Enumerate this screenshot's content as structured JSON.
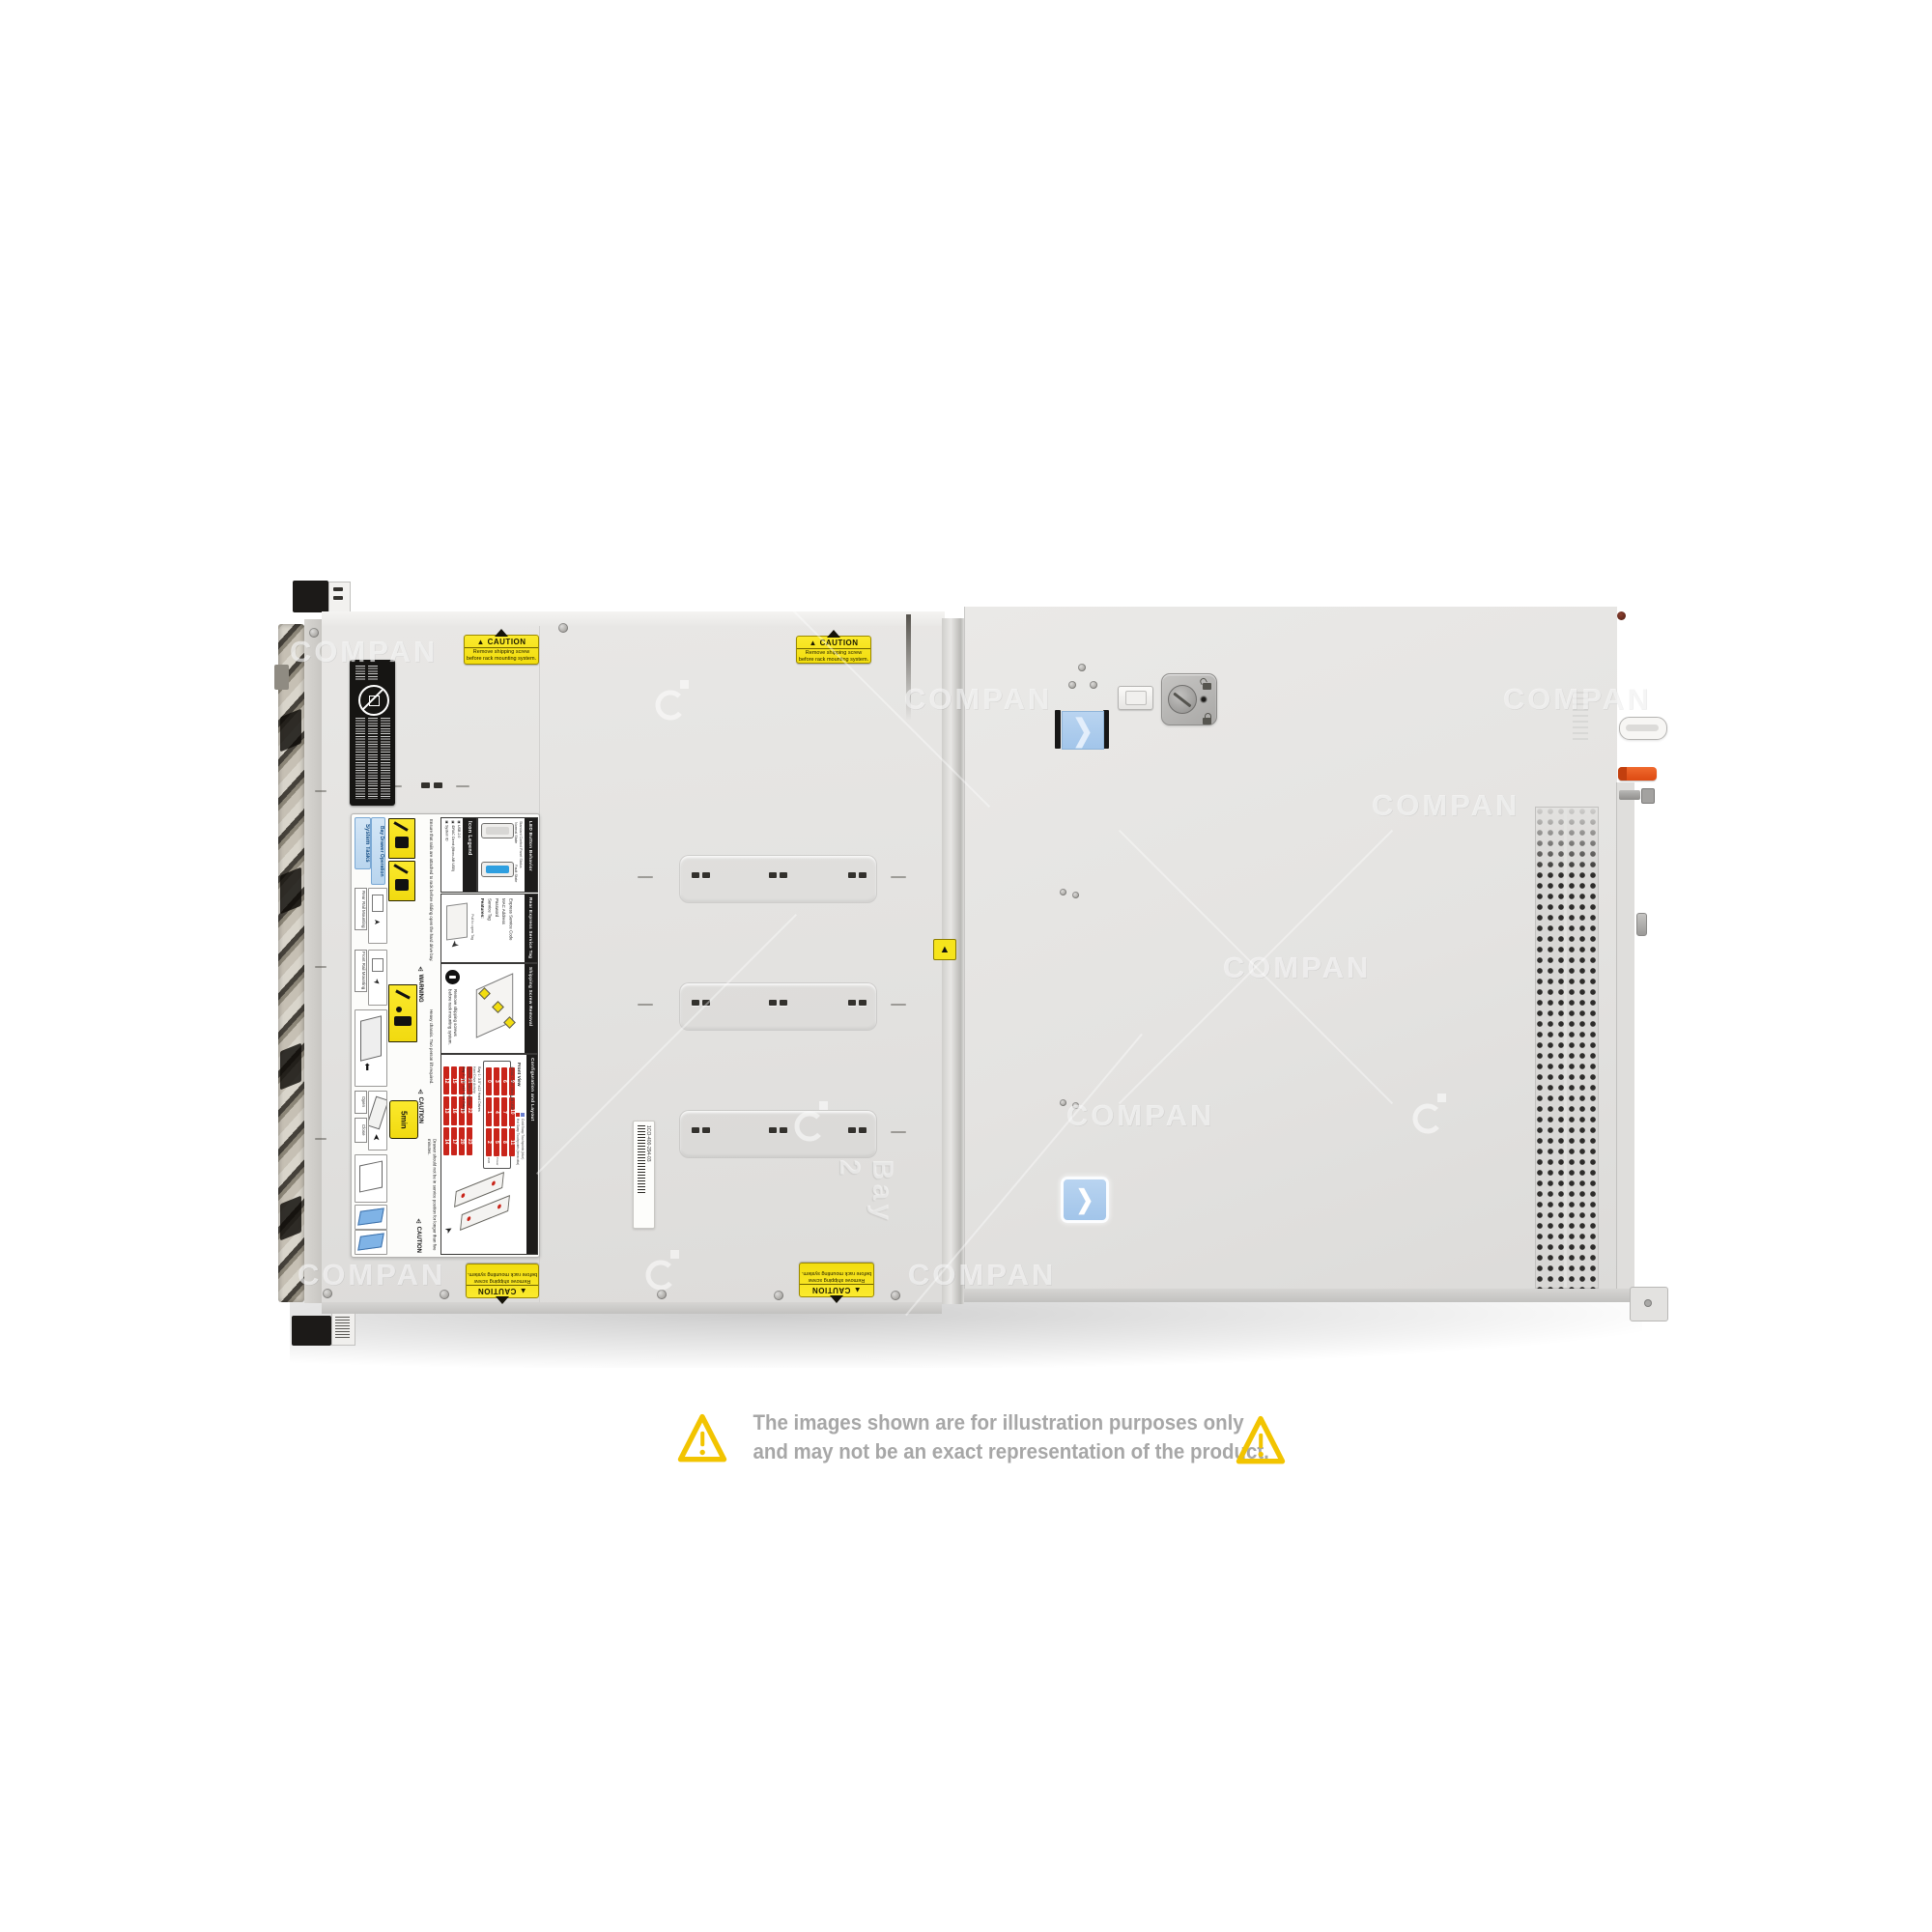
{
  "watermark": {
    "text": "COMPAN",
    "logo": "ci-logo"
  },
  "disclaimer": {
    "line1": "The images shown are for illustration purposes only",
    "line2": "and may not be an exact representation of the product.",
    "icon": "warning-triangle-icon",
    "text_color": "#a7a7a7",
    "triangle_color": "#f2c400"
  },
  "stickers": {
    "caution": {
      "title": "CAUTION",
      "icon": "warning-triangle-icon",
      "line1": "Remove shipping screw",
      "line2": "before rack mounting system.",
      "bg": "#f6e41c"
    }
  },
  "labels": {
    "regulatory": {
      "symbol": "prohibition-circle-icon"
    },
    "barcode": {
      "text": "1CO-400-294-03"
    },
    "embossed_bay": "Bay 2",
    "service": {
      "headers": {
        "system_tasks": "System Tasks",
        "bay_drawer": "Bay Drawer Operation"
      },
      "steps": {
        "rear_rail": "Rear Rail Mounting",
        "front_rail": "Front Rail Mounting",
        "open": "Open",
        "close": "Close"
      },
      "warning": {
        "title": "WARNING",
        "body": "Ensure that rails are attached to rack before sliding open the hard drive bay."
      },
      "caution_heavy": {
        "title": "CAUTION",
        "body": "Heavy chassis. Two person lift required."
      },
      "caution_drawer": {
        "title": "CAUTION",
        "body": "Drawer should not be in service position for longer than five minutes.",
        "badge": "5min"
      },
      "icon_legend": {
        "title": "Icon Legend",
        "items": [
          "System ID",
          "iDRAC Direct (Micro-AB USB)",
          "USB 2.0",
          "Activity"
        ]
      },
      "led": {
        "title": "LED Button Behavior",
        "subtitle": "Standard Control Panel Status",
        "state_normal": "Normal State",
        "state_fault": "Fault State"
      },
      "rear_tag": {
        "title": "Rear Express Service Tag",
        "features_label": "Features:",
        "features": [
          "Service Tag",
          "Password",
          "MAC Address",
          "Express Service Code"
        ],
        "note": "Pull to open Tag"
      },
      "shipping": {
        "title": "Shipping Screw Removal",
        "icon": "stop-hand-icon",
        "body": "Remove shipping screws before rack mounting system."
      },
      "config": {
        "title": "Configuration and Layout",
        "legend_hot": "Hot Swap Touchpoints (terracotta)",
        "legend_cold": "Cold Swap Touchpoints (blue)",
        "front_view": "Front View",
        "bay1_label": "Bay 1: 3.5\" x12 Hard Drives",
        "bay2_label": "Bay 2: 3.5\" x12 Hard Drives",
        "bay1_numbers": [
          "0",
          "1",
          "2",
          "3",
          "4",
          "5",
          "6",
          "7",
          "8",
          "9",
          "10",
          "11"
        ],
        "bay2_numbers": [
          "12",
          "13",
          "14",
          "15",
          "16",
          "17",
          "18",
          "19",
          "20",
          "21",
          "22",
          "23"
        ],
        "side_labels": [
          "System ID/Status Light Bar",
          "Hard Drive Activity",
          "iDRAC Direct (Micro-AB USB)",
          "USB",
          "Power"
        ]
      }
    }
  },
  "hardware_icons": {
    "latch_button": "chevron-right-icon",
    "lock": "padlock-locked-icon",
    "unlock": "padlock-unlocked-icon"
  },
  "colors": {
    "caution_yellow": "#f6e41c",
    "latch_blue": "#a9c9ec",
    "release_orange": "#e8541f",
    "touchpoint_red": "#c9241a",
    "chassis_gray": "#e4e3e1"
  }
}
